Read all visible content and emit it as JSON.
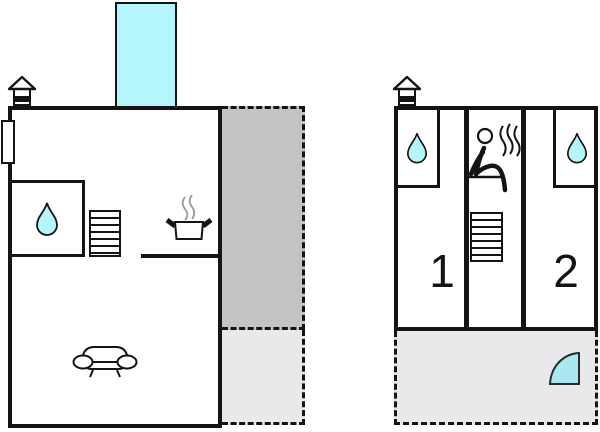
{
  "canvas": {
    "width": 600,
    "height": 432,
    "background": "#ffffff"
  },
  "colors": {
    "wall": "#141414",
    "cyan-light": "#b4f6fb",
    "cyan-door": "#a9e7f1",
    "terrace-dark": "#c4c4c4",
    "terrace-light": "#e9e9ec",
    "steam-gray": "#999999"
  },
  "main_house": {
    "name": "main house",
    "annex_extension": {
      "icon": "cyan-extension"
    },
    "entrance_icon": "chimney-house-icon",
    "door_marker": {
      "icon": "door-marker"
    },
    "bathroom": {
      "icon": "water-drop-icon"
    },
    "stairs": {
      "icon": "stairs-icon"
    },
    "kitchen": {
      "icon": "cooking-pot-icon",
      "steam": "steam-lines"
    },
    "living_room": {
      "icon": "sofa-icon"
    },
    "terrace_upper": {
      "style": "dark-gray",
      "border": "dashed"
    },
    "terrace_lower": {
      "style": "light-gray",
      "border": "dashed"
    }
  },
  "annex_house": {
    "name": "annex house",
    "entrance_icon": "chimney-house-icon",
    "rooms": [
      {
        "label": "1",
        "bathroom_icon": "water-drop-icon"
      },
      {
        "label": "2",
        "bathroom_icon": "water-drop-icon"
      }
    ],
    "sauna": {
      "icon": "sauna-person-icon",
      "steam": "steam-lines"
    },
    "stairs": {
      "icon": "stairs-icon"
    },
    "terrace": {
      "style": "light-gray",
      "border": "dashed",
      "door_icon": "quarter-door-swing-icon"
    }
  }
}
